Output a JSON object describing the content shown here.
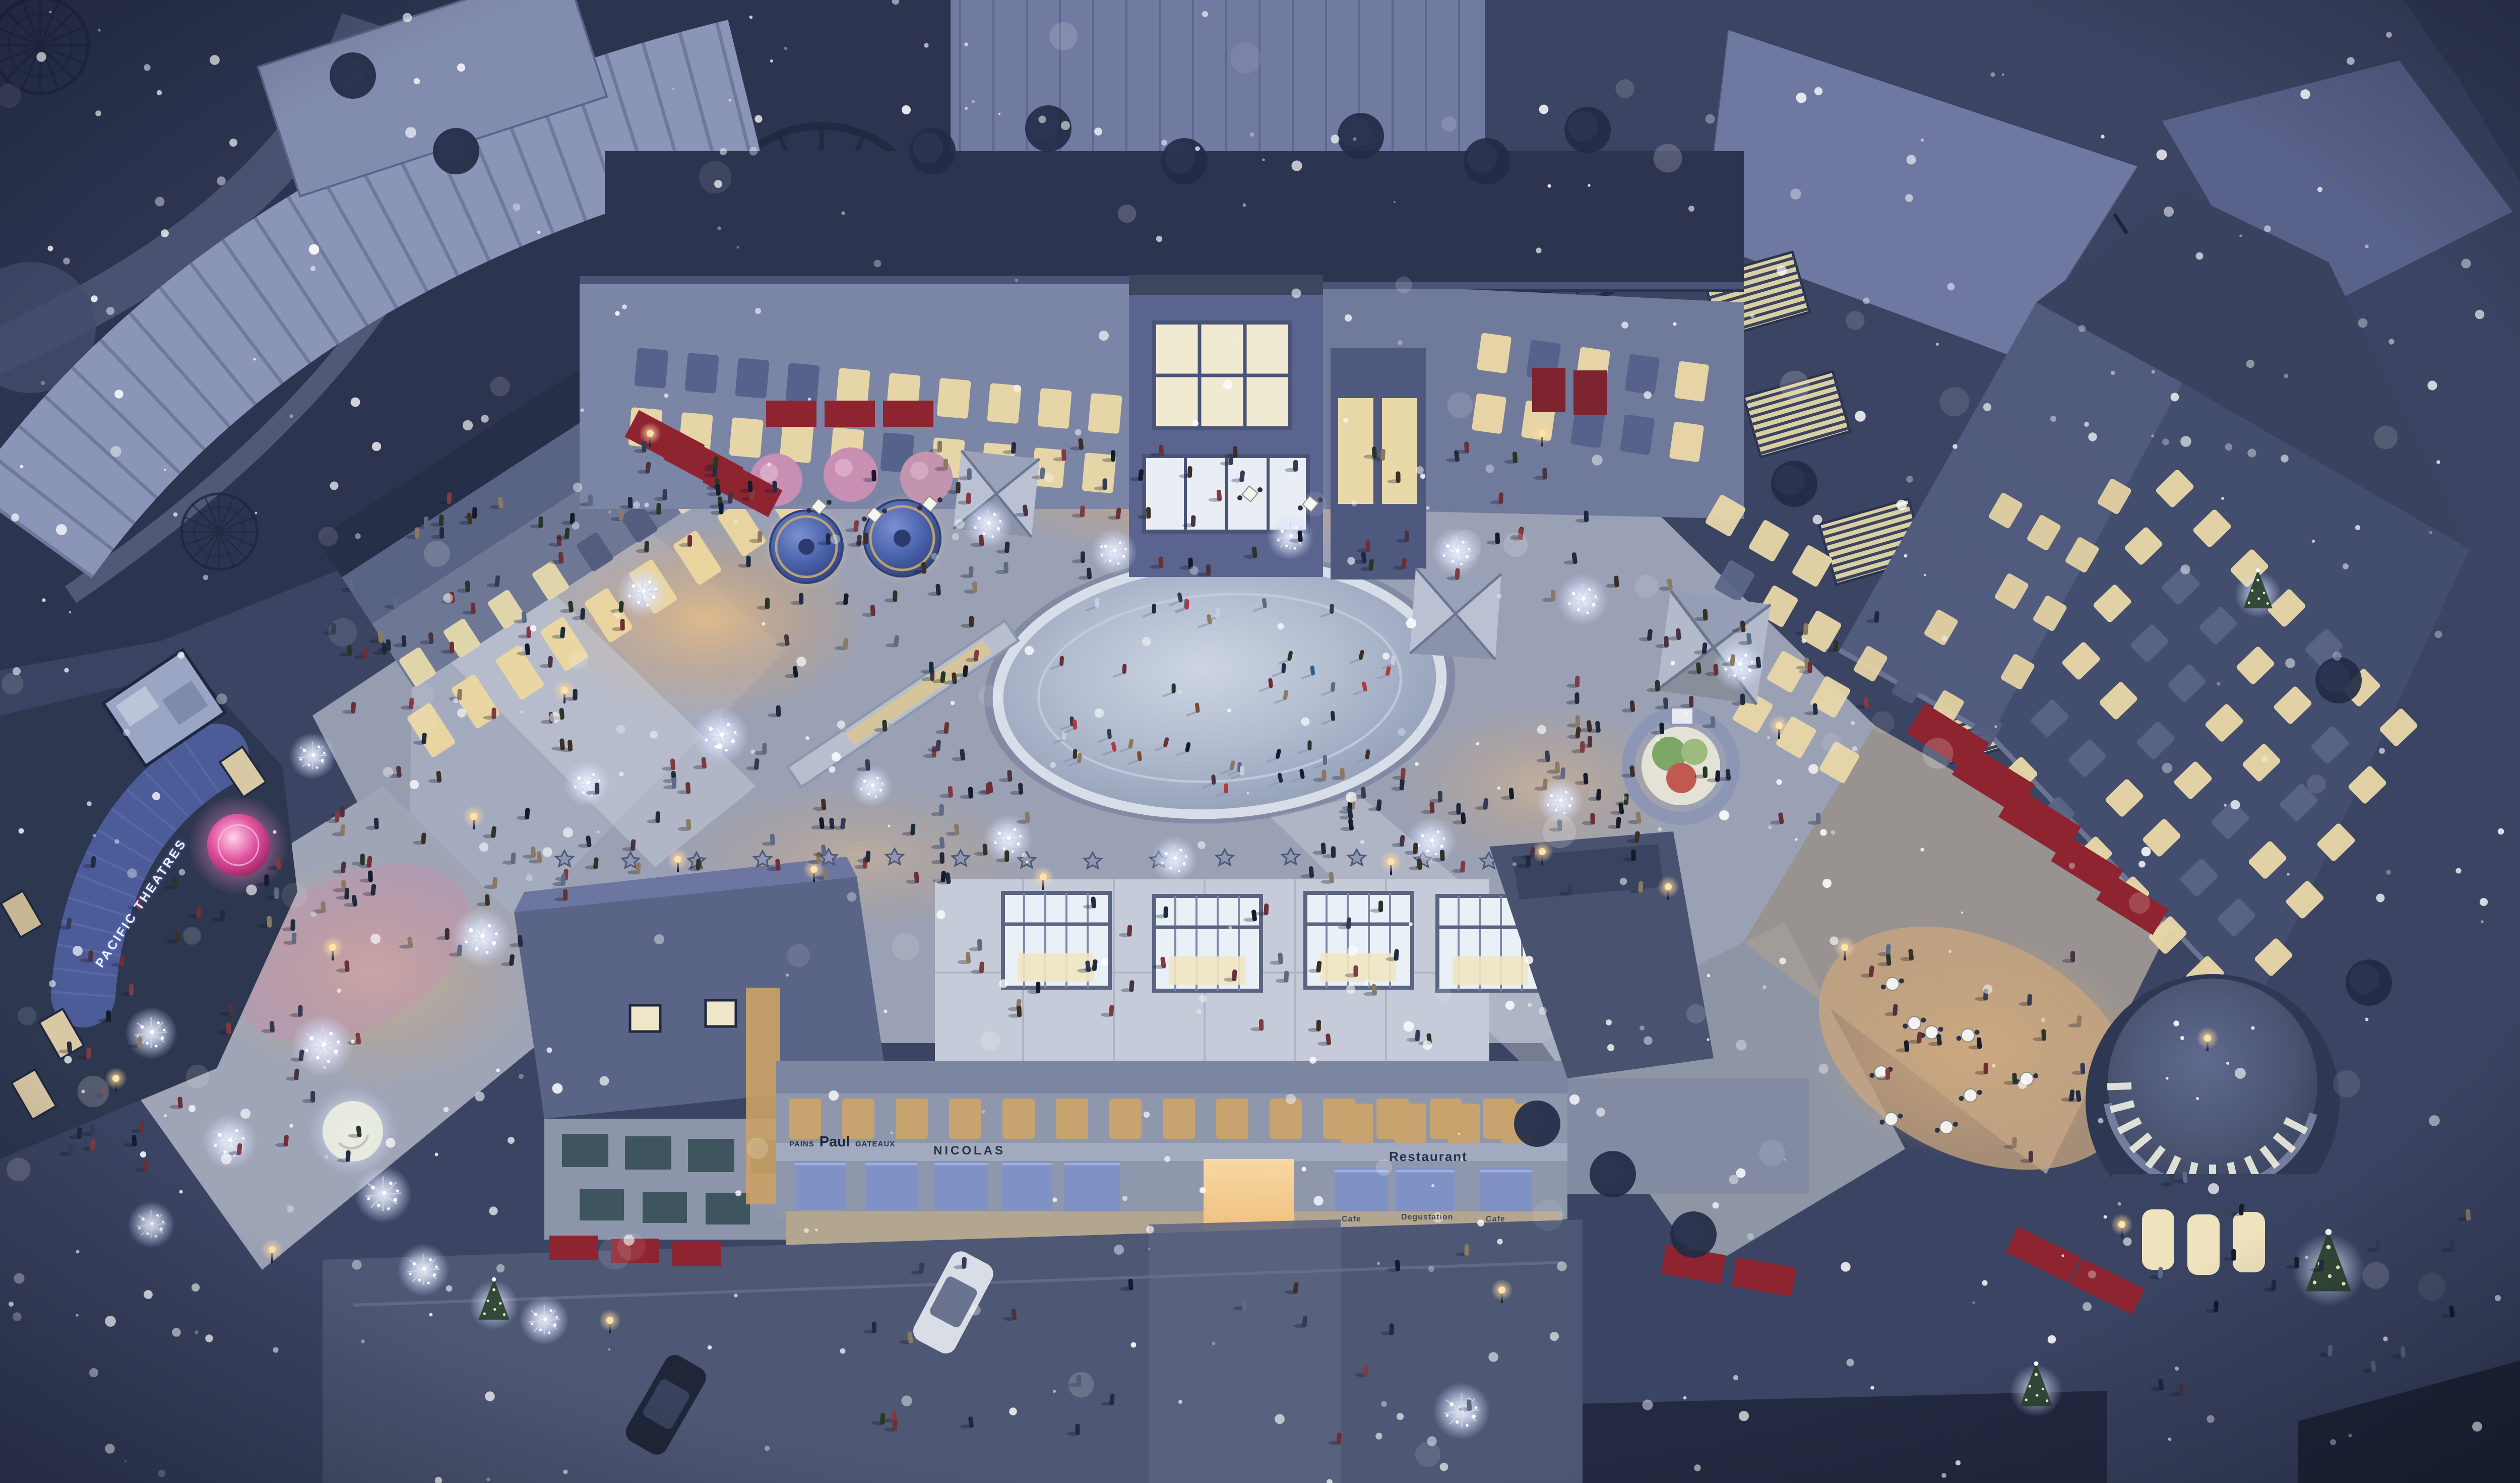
{
  "scene": {
    "type": "architectural-rendering",
    "view": "aerial night view",
    "setting": "snowy winter evening shopping plaza with central ice skating rink, illuminated storefronts, crowds, falling snow"
  },
  "signs": {
    "theater_marquee": "PACIFIC THEATRES",
    "bakery_left": "PAINS",
    "bakery_name": "Paul",
    "bakery_right": "GATEAUX",
    "wine_shop": "NICOLAS",
    "restaurant": "Restaurant",
    "awning_label_1": "Cafe",
    "awning_label_2": "Degustation",
    "awning_label_3": "Cafe"
  },
  "colors": {
    "night_base": "#3b4462",
    "park_shadow": "#2c3450",
    "arcade_roof": "#8b95b8",
    "building_dark": "#2e3750",
    "building_mid": "#6d7796",
    "plaza_paving": "#9aa1b5",
    "ice_rink": "#b9c3d4",
    "warm_window": "#ecd7a0",
    "warm_glow": "#f0c27c",
    "red_awning": "#8e2430",
    "blue_awning": "#8091c6",
    "teal_awning": "#3e5560",
    "marquee_blue": "#4c5c98",
    "pink_accent": "#e263ab",
    "kiosk_blue": "#4a63ac",
    "snow_white": "#ffffff"
  }
}
